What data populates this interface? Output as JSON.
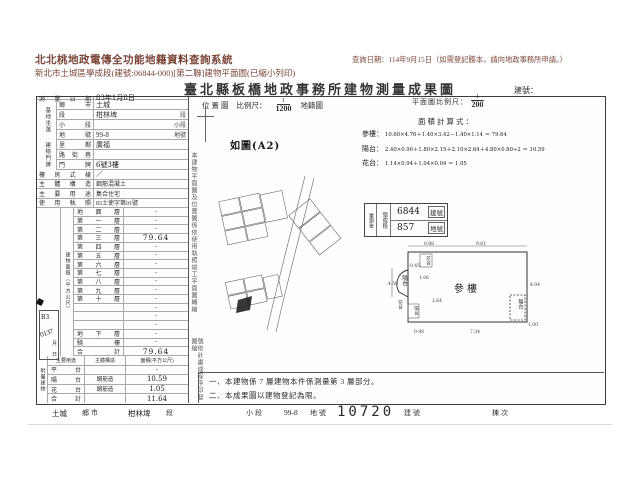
{
  "colors": {
    "header_text": "#7b4638",
    "ink": "#2e2e2e",
    "handwriting": "#161616"
  },
  "header": {
    "system_title": "北北桃地政電傳全功能地籍資料查詢系統",
    "query_date": "查詢日期：114年9月15日（如需登記謄本，請向地政事務所申請。）",
    "subtitle": "新北市土城區學成段(建號:06844-000)[第二聯]建物平面圖(已縮小列印)"
  },
  "form": {
    "title": "臺北縣板橋地政事務所建物測量成果圖",
    "building_no_label": "建號：",
    "survey_date": {
      "label": "測量日期",
      "value": "83年1月8日"
    },
    "land": {
      "group": "基地坐落",
      "rows": [
        {
          "label": "鄉市",
          "value": "土城",
          "suffix": ""
        },
        {
          "label": "段",
          "value": "柑林埤",
          "suffix": "段"
        },
        {
          "label": "小段",
          "value": "",
          "suffix": "小段"
        },
        {
          "label": "地號",
          "value": "99-8",
          "suffix": "地號"
        }
      ]
    },
    "plate": {
      "group": "建物門牌",
      "rows": [
        {
          "label": "里鄰",
          "value": "廣福",
          "suffix": ""
        },
        {
          "label": "路街巷",
          "value": "",
          "suffix": ""
        },
        {
          "label": "門牌",
          "value": "6號3樓",
          "suffix": ""
        }
      ]
    },
    "info_rows": [
      {
        "label": "樓房式樣",
        "value": "／"
      },
      {
        "label": "主體構造",
        "value": "鋼筋混凝土"
      },
      {
        "label": "主要用途",
        "value": "集合住宅"
      },
      {
        "label": "使用執照",
        "value": "83土使字第01號"
      }
    ],
    "floor_area": {
      "group": "建物面積（平方公尺）",
      "rows": [
        {
          "label": "地面層",
          "value": "·"
        },
        {
          "label": "第一層",
          "value": "·"
        },
        {
          "label": "第二層",
          "value": "·"
        },
        {
          "label": "第三層",
          "value": "79.64"
        },
        {
          "label": "第四層",
          "value": "·"
        },
        {
          "label": "第五層",
          "value": "·"
        },
        {
          "label": "第六層",
          "value": "·"
        },
        {
          "label": "第七層",
          "value": "·"
        },
        {
          "label": "第八層",
          "value": "·"
        },
        {
          "label": "第九層",
          "value": "·"
        },
        {
          "label": "第十層",
          "value": "·"
        },
        {
          "label": "",
          "value": "·"
        },
        {
          "label": "",
          "value": "·"
        },
        {
          "label": "",
          "value": "·"
        },
        {
          "label": "地下層",
          "value": "·"
        },
        {
          "label": "騎樓",
          "value": "·"
        },
        {
          "label": "合計",
          "value": "79.64"
        }
      ]
    },
    "annex": {
      "group": "附屬建物",
      "headers": [
        "主要用途",
        "主體構造",
        "面積(平方公尺)"
      ],
      "rows": [
        {
          "use": "平台",
          "structure": "",
          "area": "·"
        },
        {
          "use": "陽台",
          "structure": "鋼筋造",
          "area": "10.59"
        },
        {
          "use": "花台",
          "structure": "鋼筋造",
          "area": "1.05"
        },
        {
          "use": "合計",
          "structure": "",
          "area": "11.64"
        }
      ]
    },
    "receipt": {
      "code": "B3",
      "number": "0137",
      "month": "月",
      "day": "日"
    },
    "location": {
      "label": "位置圖",
      "scale_label": "比例尺：",
      "num": "1",
      "den": "1200",
      "ref": "地籍圖",
      "annotation": "如圖(A2)"
    },
    "vertical_notes": {
      "note1": "本建物平面圖及位置圖係依使用執照竣工平面圖轉繪",
      "note2": "號依計畫成程序印發圖繪"
    },
    "plan": {
      "scale_label": "平面圖比例尺：",
      "num": "1",
      "den": "200",
      "calc_title": "面積計算式：",
      "calcs": [
        {
          "label": "參樓：",
          "expr": "10.60×4.76＋1.40×3.42－1.40×1.14 ＝ 79.64"
        },
        {
          "label": "陽台：",
          "expr": "2.40×0.90＋1.80×2.15＋2.10×2.64＋4.80×0.80÷2 ＝ 10.59"
        },
        {
          "label": "花台：",
          "expr": "1.14×0.94＋1.04×0.04 ＝ 1.05"
        }
      ]
    },
    "resurvey": {
      "col1": "重測後",
      "col2": "學成段",
      "rows": [
        {
          "value": "6844",
          "label": "建號"
        },
        {
          "value": "857",
          "label": "地號"
        }
      ]
    },
    "floorplan": {
      "main": "參樓",
      "balcony": "陽台",
      "flower": "花台",
      "dims": {
        "top1": "0.88",
        "top2": "9.61",
        "right1": "4.04",
        "right2": "1.00",
        "bottom1": "0.98",
        "bottom2": "7.34",
        "left1": "4.50",
        "n1": "0.45",
        "n2": "1.06",
        "n3": "2.64"
      }
    },
    "notes": {
      "line1": "一、本建物係 7 層建物本件係測量第 3 層部分。",
      "line2": "二、本成果圖以建物登記為限。"
    },
    "bottom": {
      "f1": "土城",
      "f1l": "鄉市",
      "f2": "柑林埤",
      "f2l": "段",
      "f3l": "小段",
      "f4": "99-8",
      "f4l": "地號",
      "f5": "10720",
      "f5l": "建號",
      "f6l": "棟次"
    }
  }
}
